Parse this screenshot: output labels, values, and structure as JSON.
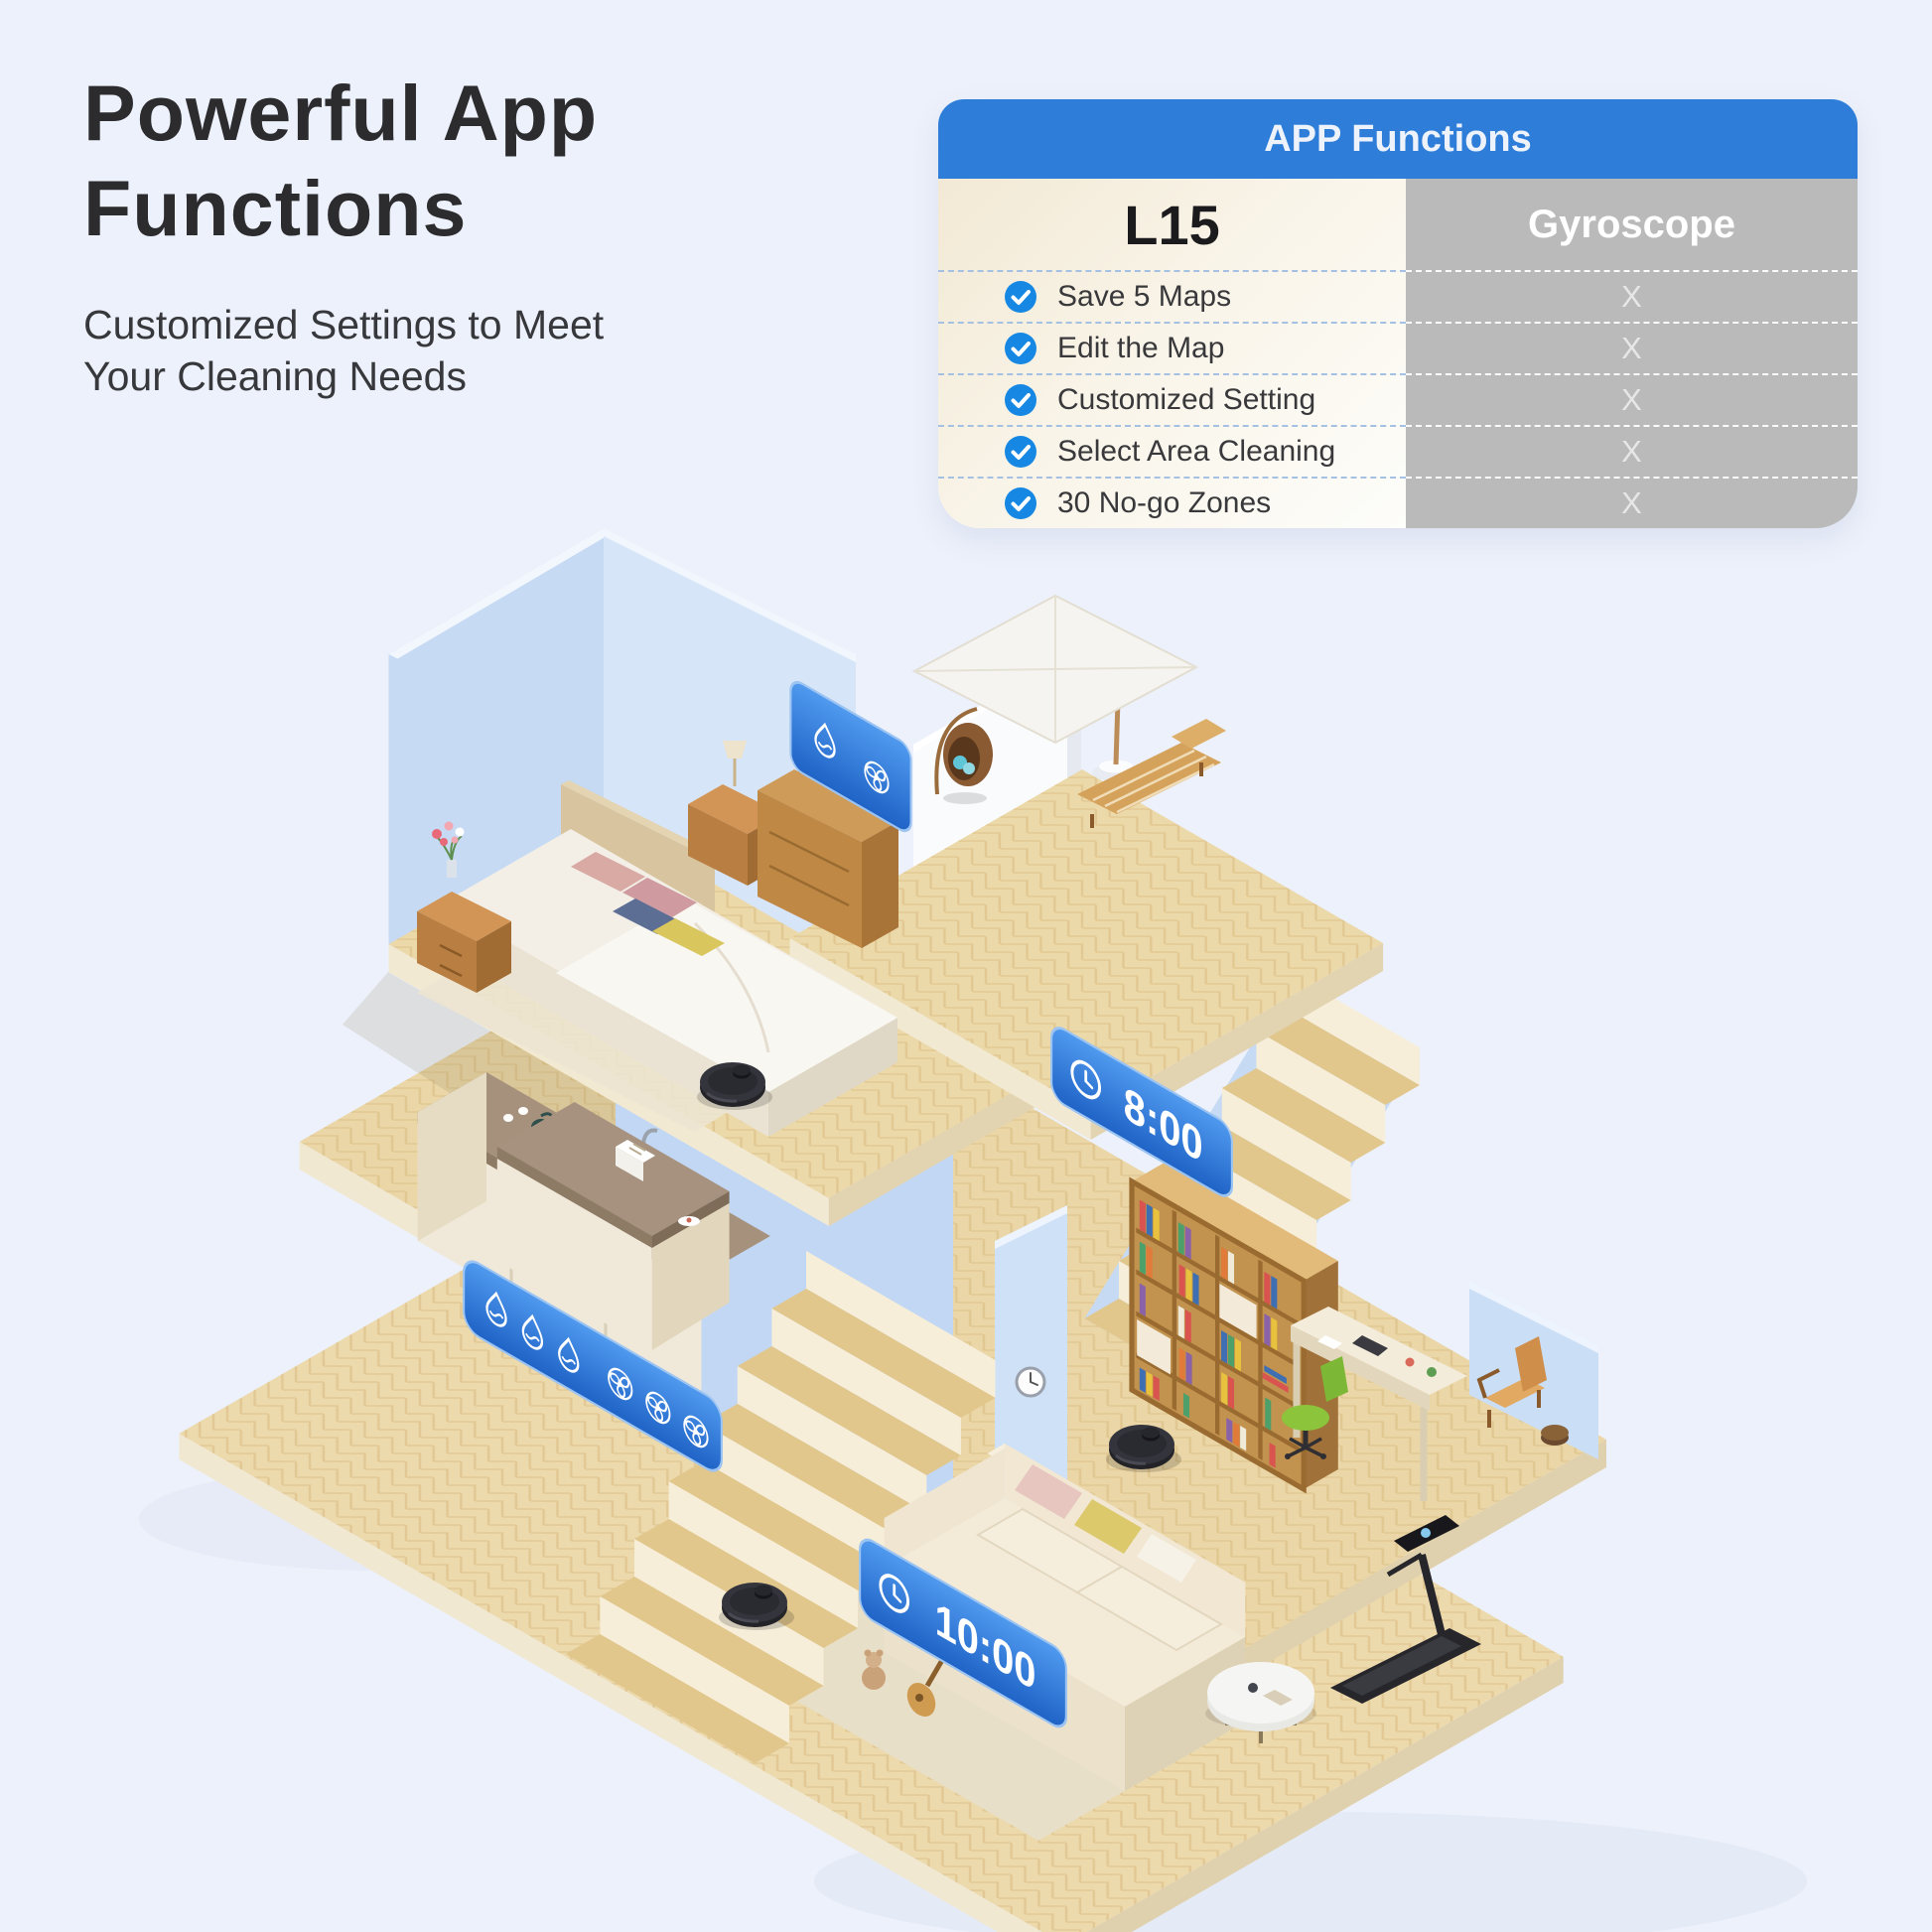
{
  "page": {
    "background_color": "#edf1fb"
  },
  "headline": {
    "title_line1": "Powerful App",
    "title_line2": "Functions",
    "subtitle_line1": "Customized Settings to Meet",
    "subtitle_line2": "Your Cleaning Needs"
  },
  "comparison_table": {
    "header": "APP Functions",
    "product_column": "L15",
    "competitor_column": "Gyroscope",
    "rows": [
      {
        "feature": "Save 5 Maps",
        "product": "check-icon",
        "competitor": "X"
      },
      {
        "feature": "Edit the Map",
        "product": "check-icon",
        "competitor": "X"
      },
      {
        "feature": "Customized Setting",
        "product": "check-icon",
        "competitor": "X"
      },
      {
        "feature": "Select Area Cleaning",
        "product": "check-icon",
        "competitor": "X"
      },
      {
        "feature": "30 No-go Zones",
        "product": "check-icon",
        "competitor": "X"
      }
    ],
    "colors": {
      "header_bar": "#2e7ed9",
      "check_circle": "#1688e3",
      "competitor_bg": "#b9bab9"
    }
  },
  "scene": {
    "description": "Isometric three-floor home with robot vacuums cleaning each level",
    "badges": {
      "bedroom_icons": [
        "water-drop-icon",
        "fan-icon"
      ],
      "kitchen_icons": [
        "water-drop-icon",
        "water-drop-icon",
        "water-drop-icon",
        "fan-icon",
        "fan-icon",
        "fan-icon"
      ],
      "office_schedule_time": "8:00",
      "living_room_schedule_time": "10:00"
    },
    "robot_count": 3,
    "badge_color": "#2f7bdd"
  }
}
